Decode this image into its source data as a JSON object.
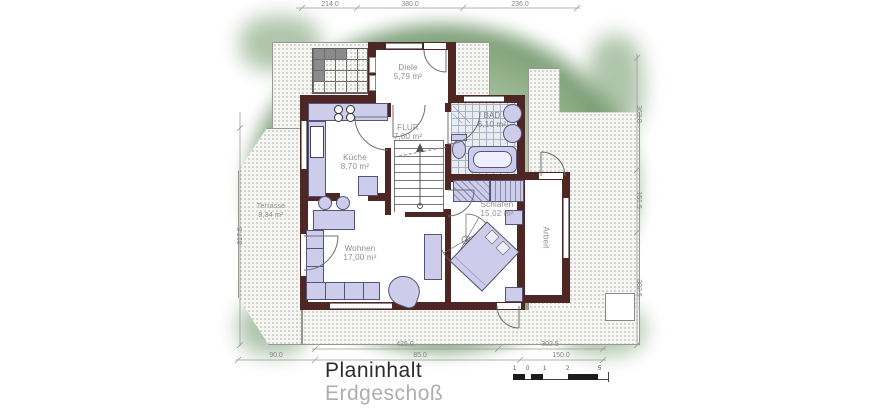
{
  "title_block": {
    "line1": "Planinhalt",
    "line2": "Erdgeschoß"
  },
  "rooms": {
    "diele": {
      "name": "Diele",
      "area": "5,79 m²"
    },
    "flur": {
      "name": "FLUR",
      "area": "7,60 m²"
    },
    "kueche": {
      "name": "Küche",
      "area": "8,70 m²"
    },
    "bad": {
      "name": "BAD",
      "area": "6,10 m²"
    },
    "schlafen": {
      "name": "Schlafen",
      "area": "15,02 m²"
    },
    "wohnen": {
      "name": "Wohnen",
      "area": "17,00 m²"
    },
    "arbeit": {
      "name": "Arbeit"
    },
    "terrasse": {
      "name": "Terrasse",
      "area": "8,34 m²"
    }
  },
  "dimensions": {
    "top": [
      "214.0",
      "380.0",
      "236.0"
    ],
    "bottom_row1": [
      "425.0",
      "302.5"
    ],
    "bottom_row2": [
      "90.0",
      "85.0",
      "150.0"
    ],
    "right": [
      "363.0",
      "151.5",
      "302.5"
    ],
    "left": [
      "317.5"
    ]
  },
  "scale_bar": {
    "labels": [
      "1",
      "0",
      "1",
      "2",
      "5"
    ]
  },
  "colors": {
    "wall": "#4e2724",
    "furniture": "#cdcdeb",
    "garden": "#9dbb97",
    "label": "#8c8c96"
  }
}
